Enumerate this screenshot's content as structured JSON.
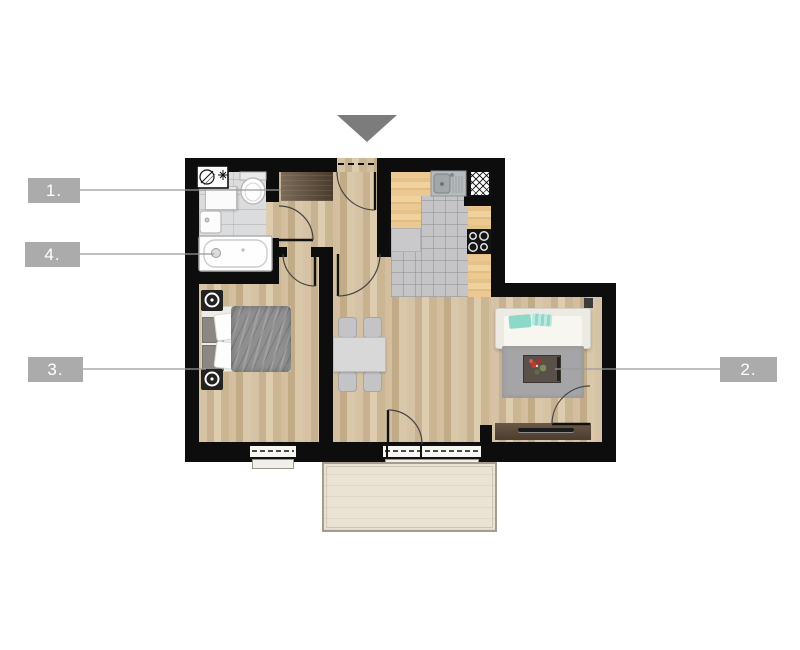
{
  "floor_plan": {
    "callouts": [
      {
        "text": "1.",
        "target": "hallway"
      },
      {
        "text": "2.",
        "target": "living-room"
      },
      {
        "text": "3.",
        "target": "bedroom"
      },
      {
        "text": "4.",
        "target": "bathroom"
      }
    ],
    "entrance_marker": "triangle-down",
    "colors": {
      "wall": "#0d0d0d",
      "callout_bg": "#ababab",
      "callout_text": "#ffffff",
      "wood_floor": "#d2bd9d",
      "kitchen_counter": "#ecc993",
      "kitchen_tile": "#c5c5c7",
      "bathroom_tile": "#dbdcdd",
      "balcony_floor": "#eae2d2",
      "rug": "#a5a5a7",
      "bed_duvet": "#8f8f8f",
      "wardrobe": "#5a4936",
      "tv_console": "#5e4c3c",
      "sofa": "#f3f2ee",
      "sofa_pillow_accent": "#8ed8c9",
      "entrance_triangle": "#7c7c7c",
      "callout_line": "#9a9a9a"
    }
  }
}
